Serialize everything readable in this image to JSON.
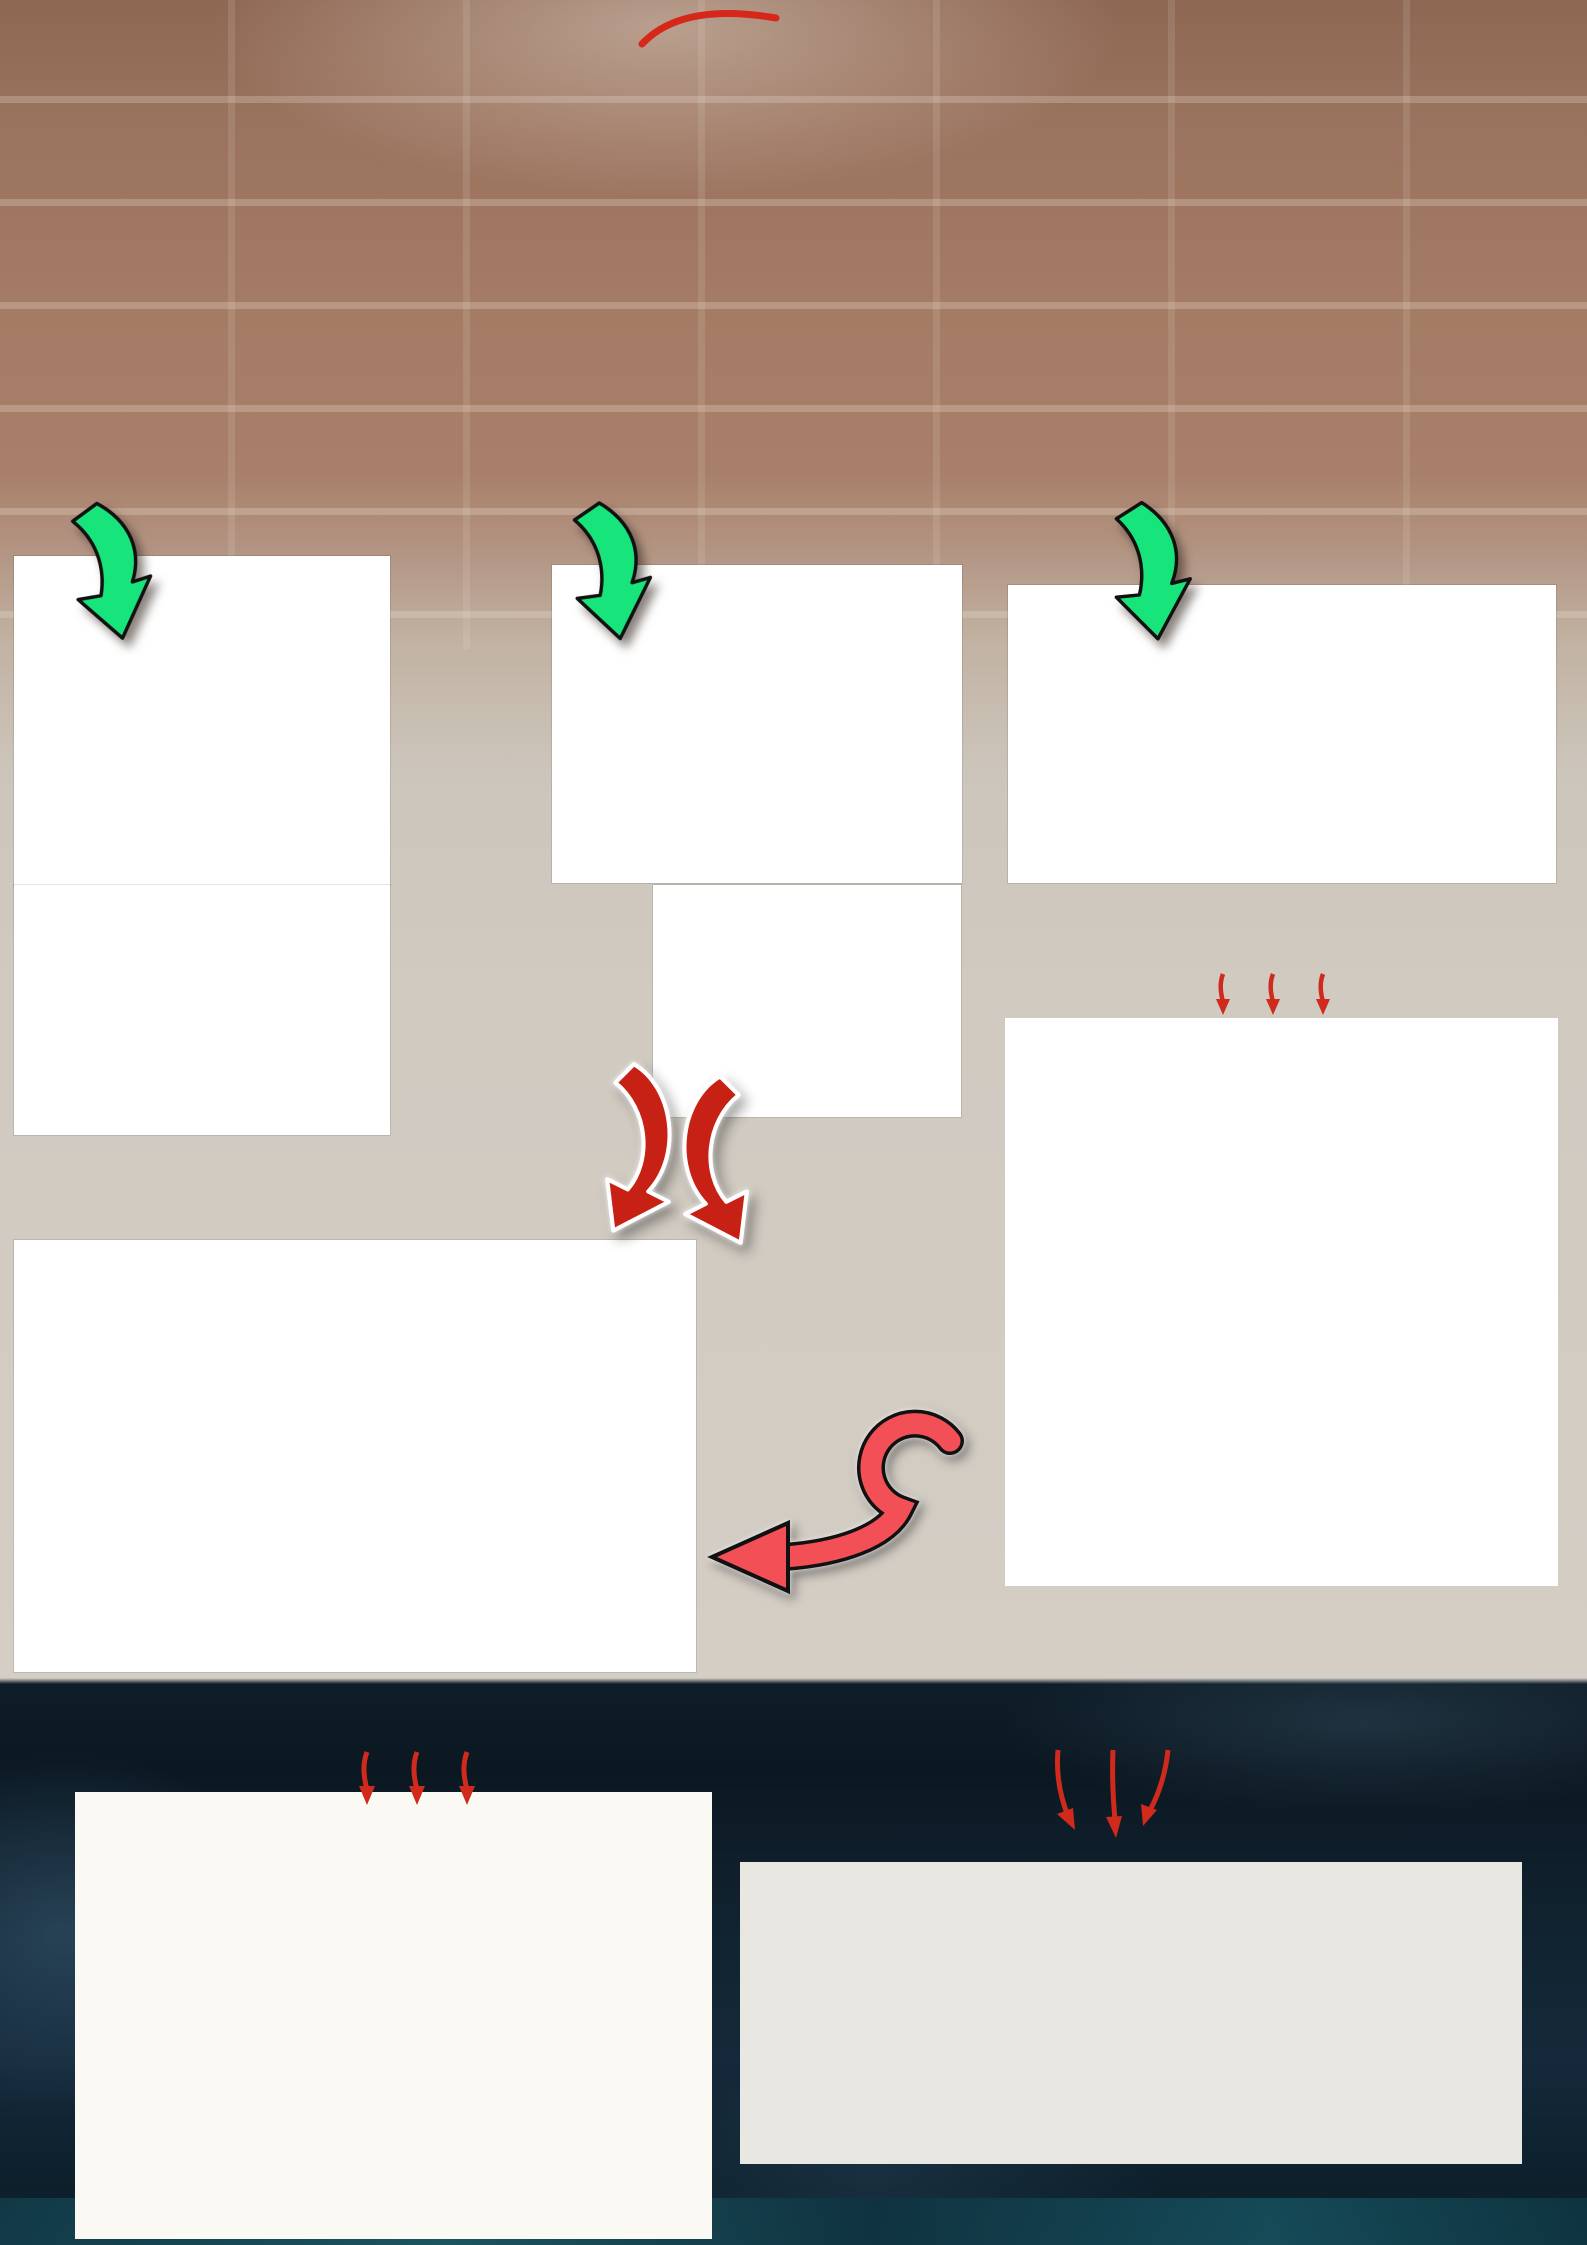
{
  "logo": {
    "text": "Politeknik Caltex Riau"
  },
  "colors": {
    "accent_red": "#df261d",
    "arrow_green": "#17e57b",
    "logo_teal": "#135a74",
    "background_brick": "#9c7460",
    "background_dark": "#0e1d28",
    "wire_red": "#d23b2f",
    "wire_yellow": "#e8d93c",
    "wire_blue": "#3947d4"
  },
  "header": {
    "title_line1": "\"PERANCANGAN DAN PEMBUATAN MODUL BELAJAR RANGKAIAN MOTOR",
    "title_line2": "DAHLANDER 2 KECEPATAN BERBASIS PROGRAMMABLE LOGIC",
    "title_line3": "CONTROLLER\"",
    "author": "Sugadul, Syahrizal, S.T.,M.T.",
    "affiliation1": "Politeknik Caltex Riau, sugadul17tl@mahasiswa.pcr.ac.id",
    "affiliation2": "Politeknik Caltex Riau, ijal@pcr.ac.id"
  },
  "section_labels": {
    "block": {
      "line1": "Diagram Blok",
      "line2": "Sistem"
    },
    "flow": {
      "line1": "Perancangan",
      "line2": "Flowchart"
    },
    "daya": "Diagram Daya",
    "perencanaan": {
      "line1": "Perencanaan",
      "line2": "Sistem"
    },
    "hasil": {
      "line1": "Hasil",
      "line2": "Perencanaan"
    },
    "abstrak": "Abstrak",
    "kontrol": "Diagram Kontrol",
    "kesimpulan": "Kesimpulan",
    "saran": "Saran"
  },
  "block_diagram": {
    "nodes": [
      "HMI SCADA\nSOFTWARE",
      "PLC",
      "R5 AKTIF",
      "R1 DAN R3\nAKTIF",
      "R2 AKTIF",
      "R4 DAN K3\nAKTIF",
      "K5 AKTIF",
      "K1 DAN K3\nAKTIF",
      "K2 AKTIF",
      "K4 DAN K3\nAKTIF",
      "MOTOR 3 FASA"
    ]
  },
  "flowchart": {
    "start": "MULAI",
    "step1": "MENGONTROL MOTOR\nDAHLANDER SECARA VIRTUAL\nMENGGUNAKAN SISTEM HMI\nSCADA DENGAN SOFTWARE\nWONDERWARE INTOUCH",
    "step2": "PLC MENENTUKAN\nINPUT OUTPUT UNTUK\nMOTOR DAHLANDER",
    "decisions": [
      "R5\nAKTIF",
      "R1 DAN\nR3\nAKTIF",
      "R2\nAKTIF",
      "R4 DAN\nR3\nAKTIF"
    ],
    "no_label": "TIDAK",
    "yes_label": "YA",
    "outputs": [
      "KECEPATAN MOTOR\nRENDAH DENGAN\nARAH PUTAR KEKANAN",
      "KECEPATAN MOTOR\nTINGGI DENGAN ARAH\nPUTAR KEKANAN",
      "KECEPATAN MOTOR\nRENDAH DENGAN\nARAH PUTAR KEKIRI",
      "KECEPATAN MOTOR\nTINGGI DENGAN ARAH\nPUTAR KEKIRI"
    ],
    "end": "SELESAI"
  },
  "daya": {
    "phases": [
      "R",
      "S",
      "T",
      "N"
    ],
    "mcb": "MCB",
    "contactors": [
      "K4",
      "K3",
      "K5",
      "K2",
      "K1"
    ],
    "overload": "THERMAL\nOVERLOAD",
    "motor": "MOTOR\n3\nFASA",
    "terminals_top": [
      "U1",
      "V1",
      "W1"
    ],
    "terminals_bottom": [
      "U2",
      "V2",
      "W2"
    ]
  },
  "ladder": {
    "supply": "+24V",
    "zero": "0V",
    "emergency": "E",
    "top_numbers": [
      "2",
      "3",
      "4",
      "5",
      "6",
      "7",
      "8",
      "9",
      "10"
    ],
    "contacts": [
      "PB1E",
      "K5",
      "PB2E",
      "K1",
      "K1",
      "PB3E",
      "K2",
      "PB4E",
      "K4",
      "K4"
    ],
    "contact_pin_top": "3",
    "contact_pin_bottom": "4",
    "mid_contacts": [
      "K1",
      "K4"
    ],
    "mid_pin_top": "1",
    "mid_pin_bottom": "2",
    "first_pin": "1",
    "second_pin": "2",
    "coils": [
      "K5",
      "K1",
      "K3",
      "K2",
      "K4",
      "K3"
    ],
    "coil_top": "A1",
    "coil_bottom": "A2",
    "bottom_groups": [
      [
        "2"
      ],
      [
        "4",
        "5"
      ],
      [
        "7"
      ],
      [
        "6",
        "9",
        "10"
      ]
    ]
  },
  "abstract": {
    "segments": [
      {
        "t": "Motor dahlander adalah motor induksi 3 fasa yang memiliki dua kecepatan. Perbedaan kecepatan pada motor dahlander di dapat dengan prinsip perubahan jumlah kutub pada stator motor tersebut. Pada penelitian ini perancangan dan pembuatan modul belajar rangkaian motor dahlander 2 kecepatan berbasis "
      },
      {
        "t": "Programmable Logic Controller",
        "i": 1
      },
      {
        "t": ". Untuk memenuhi keperluan tersebut, sistem kontrol yang digunakan untuk mengontrol motor dahlander pada modul belajar ini menggunakan PLC TM221 sebagai pengolah data dan kontroler. Pengukuran menggunakan "
      },
      {
        "t": "tachometer",
        "i": 1
      },
      {
        "t": " sebagai pengukur kecepatan motor dahlander. Cara kerja perancangan ini mengacu pada sistem "
      },
      {
        "t": "Supervisory Control And Data Acquisition",
        "i": 1
      },
      {
        "t": " (SCADA). Berdasarkan hasil pengujian tingkat keberhasilan sistem kontrol motor dahlander berbasis "
      },
      {
        "t": "Supervisory Control And Data Acquisition",
        "i": 1
      },
      {
        "t": " (SCADA) menggunakan "
      },
      {
        "t": "Programmable Logic Controller",
        "i": 1
      },
      {
        "t": " sebesar 99.36%, untuk percobaan "
      },
      {
        "t": "forward low speed",
        "i": 1
      },
      {
        "t": ", untuk percobaan "
      },
      {
        "t": "forward high speed",
        "i": 1
      },
      {
        "t": " sebesar 99.82%, sedangkan pada percobaan "
      },
      {
        "t": "reverse low speed",
        "i": 1
      },
      {
        "t": " dan "
      },
      {
        "t": "reverse high speed",
        "i": 1
      },
      {
        "t": " adalah sebesar 99.8% dan 99.86%. Disamping itu perancangan ini dilengkapi dengan sistem kontrol menggunakan aplikasi "
      },
      {
        "t": "wonderware intouch",
        "i": 1
      },
      {
        "t": " untuk mempermudah pengotrolan motor dahlander secara otomatis. Dengan adanya perancangan dan pembuatan modul belajar rangkaian motor dahlander 2 kecepatan berbasis PLC diharapkan dapat membantu mahasiswa Politeknik Caltex Riau Terkhusus untuk mahasiswa Program Studi Teknik Listrik dalam memahami prinsip kerja dari motor dahlander secara otomatis."
      }
    ]
  },
  "kesimpulan": {
    "items": [
      [
        {
          "t": "Sistem kontrol berbasis "
        },
        {
          "t": "Supervisory Control And Data Acquisition",
          "i": 1
        },
        {
          "t": " (SCADA) motor dahlander menggunakan PLC dapat dikontrol melalui "
        },
        {
          "t": "wonderware intouch.",
          "i": 1
        }
      ],
      [
        {
          "t": "Dengan membandingkan kondisi awal motor sebelum dan sesudah dikontrol secara otomatis menggunakan PLC, hasil kecepatan yang dihasilkan adalah sama sehingga perancangan dapat bekerja dengan optimal dalam mengontrol motor dahlander."
        }
      ],
      [
        {
          "t": "Berdasarkan hasil pengujian tingkat keberhasilan sistem kontrol motor dahlander berbasis "
        },
        {
          "t": "Supervisory Control And Data Acquisition",
          "i": 1
        },
        {
          "t": " (SCADA) menggunakan PLC pada percobaan "
        },
        {
          "t": "forward low speed",
          "i": 1
        },
        {
          "t": " diperoleh tingkat keakurasian data sebesar 99.36%, untuk percobaan "
        },
        {
          "t": "forward high speed",
          "i": 1
        },
        {
          "t": " sebesar 99.82%, sedangkan pada percobaan "
        },
        {
          "t": "reverse low speed",
          "i": 1
        },
        {
          "t": " dan "
        },
        {
          "t": "reverse high speed",
          "i": 1
        },
        {
          "t": " adalah sebesar 99.8% dan 99.86%."
        }
      ]
    ]
  },
  "saran": {
    "items": [
      [
        {
          "t": "Sebaiknya sistem kontrol berbasis "
        },
        {
          "t": "Supervisory Control And Data Acquisition",
          "i": 1
        },
        {
          "t": " (SCADA) untuk motor dahlander pada tampilan "
        },
        {
          "t": "wonderware intouch",
          "i": 1
        },
        {
          "t": " dibuat lebih terancang sesuai dengan kondisi yang terjadi pada motor dahlander ."
        }
      ],
      [
        {
          "t": "Sebaiknya sistem kontrol konvensional untuk motor dahlander tidak dirancang bersamaan dengan sistem kontrol otomatis menggunakan PLC."
        }
      ]
    ]
  }
}
